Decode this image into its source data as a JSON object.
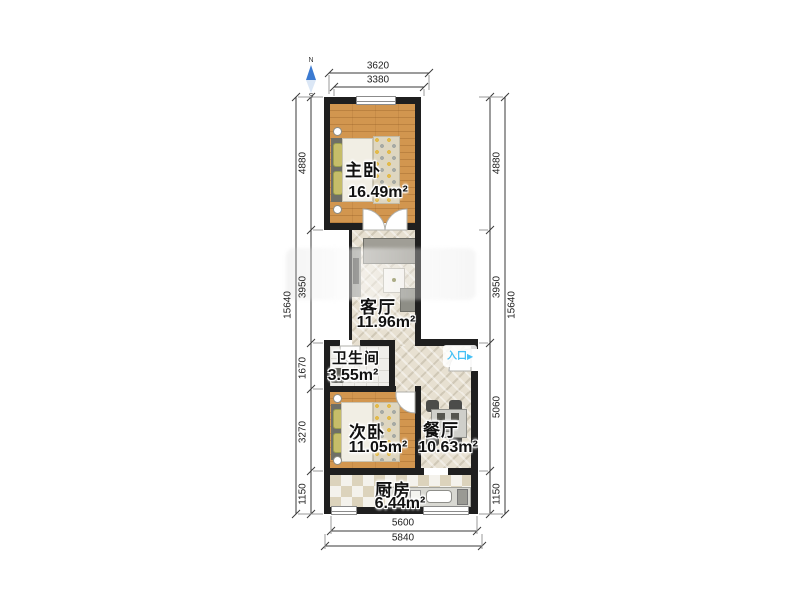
{
  "compass": {
    "north": "N",
    "south": "S"
  },
  "entrance": {
    "label": "入口",
    "arrow_icon": "▶"
  },
  "rooms": {
    "master_bedroom": {
      "name": "主卧",
      "area": "16.49m²"
    },
    "living_room": {
      "name": "客厅",
      "area": "11.96m²"
    },
    "bathroom": {
      "name": "卫生间",
      "area": "3.55m²"
    },
    "second_bedroom": {
      "name": "次卧",
      "area": "11.05m²"
    },
    "dining_room": {
      "name": "餐厅",
      "area": "10.63m²"
    },
    "kitchen": {
      "name": "厨房",
      "area": "6.44m²"
    }
  },
  "dimensions": {
    "top": {
      "outer": "3620",
      "inner": "3380"
    },
    "bottom": {
      "inner": "5600",
      "outer": "5840"
    },
    "left": {
      "total": "15640",
      "segments": [
        "4880",
        "3950",
        "1670",
        "3270",
        "1150"
      ]
    },
    "right": {
      "total": "15640",
      "segments": [
        "4880",
        "3950",
        "5060",
        "1150"
      ]
    }
  },
  "colors": {
    "wall": "#1f1f1f",
    "wood-floor": "#d2964f",
    "tile-floor": "#e7e0d1",
    "bath-floor": "#efeeea",
    "kitchen-tile-dark": "#dcd3bc",
    "accent-entrance": "#45c0f5",
    "compass-north": "#3b7ad1",
    "dim-line": "#3a3a3a"
  }
}
